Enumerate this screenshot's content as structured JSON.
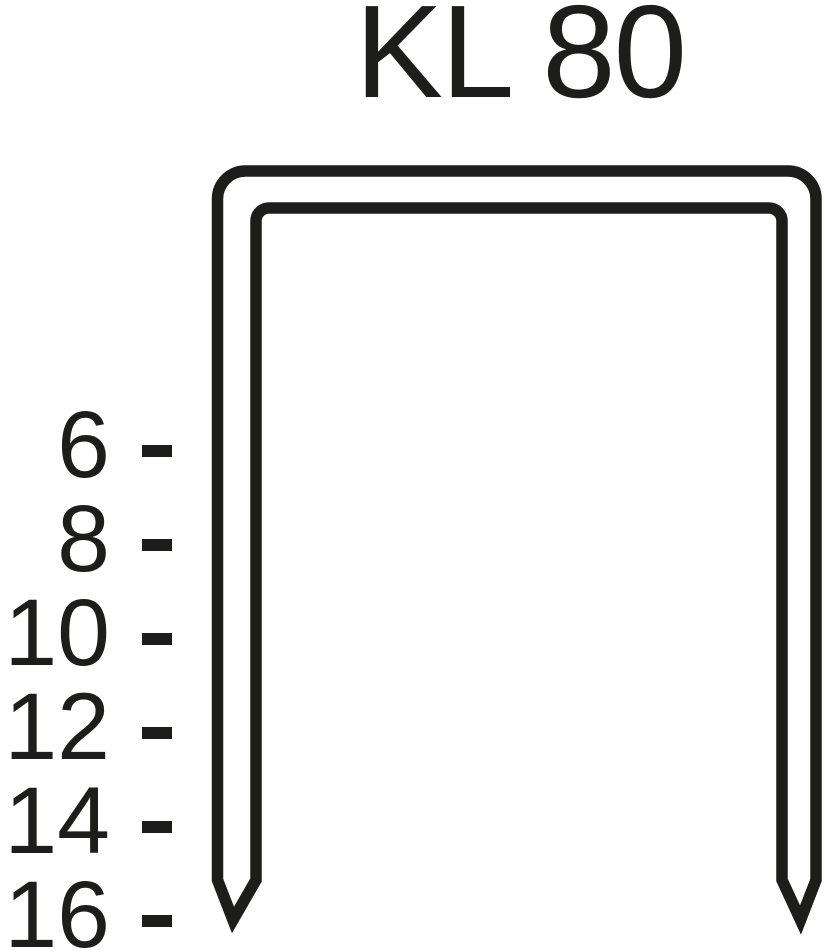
{
  "title": "KL 80",
  "colors": {
    "ink": "#1d1d1b",
    "background": "#ffffff"
  },
  "diagram": {
    "shape": "staple-outline",
    "size_labels": [
      "6",
      "8",
      "10",
      "12",
      "14",
      "16"
    ],
    "tick_glyph": "-"
  }
}
